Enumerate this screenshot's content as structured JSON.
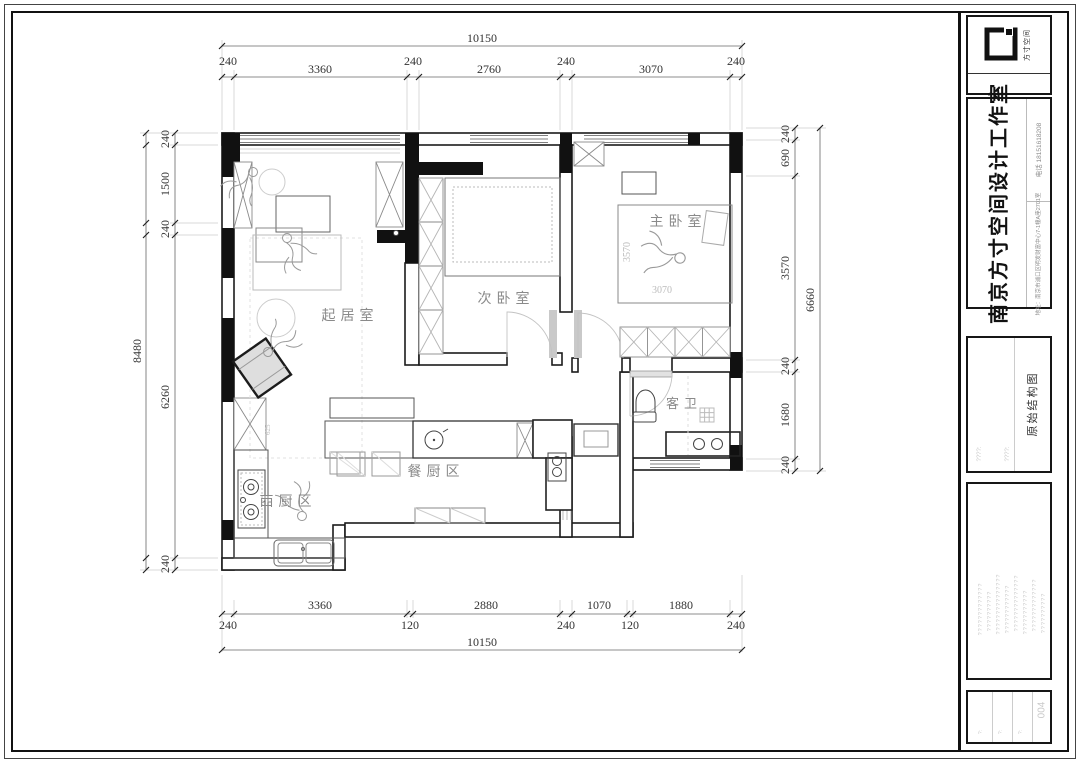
{
  "sheet": {
    "background": "#ffffff",
    "line_color": "#1c1c1c",
    "dim_color": "#333333",
    "furniture_color": "#999999",
    "room_label_color": "#8a8a8a",
    "placeholder_color": "#c9c9c9"
  },
  "title_block": {
    "logo_label": "方寸空间",
    "company_name": "南京方寸空间设计工作室",
    "phone": "电话 18151618208",
    "address": "地址：南京市浦口区明发财富中心7-1幢A座2701室",
    "drawing_title": "原始结构图",
    "meta_left": "????:",
    "meta_right": "????:",
    "sheet_number": "004",
    "notes": [
      "?????????????",
      "??????????",
      "???????????????",
      "????????????",
      "??????????????",
      "???????????",
      "?????????????",
      "??????????"
    ],
    "footer_labels": [
      "?:",
      "?:",
      "?:"
    ]
  },
  "plan": {
    "room_labels": {
      "living": "起居室",
      "bedroom2": "次卧室",
      "master": "主卧室",
      "bath": "客卫",
      "dining": "餐厨区",
      "west_kitchen": "西厨区"
    },
    "interior_dims": {
      "master_depth": "3570",
      "master_width": "3070",
      "cabinet": "625"
    },
    "dimensions": {
      "top": {
        "total": "10150",
        "segments": [
          "240",
          "3360",
          "240",
          "2760",
          "240",
          "3070",
          "240"
        ]
      },
      "bottom": {
        "total": "10150",
        "segments": [
          "240",
          "3360",
          "120",
          "2880",
          "240",
          "1070",
          "120",
          "1880",
          "240"
        ]
      },
      "left": {
        "total": "8480",
        "segments": [
          "240",
          "1500",
          "240",
          "6260",
          "240"
        ]
      },
      "right": {
        "total": "6660",
        "segments": [
          "240",
          "690",
          "3570",
          "240",
          "1680",
          "240"
        ]
      }
    }
  }
}
